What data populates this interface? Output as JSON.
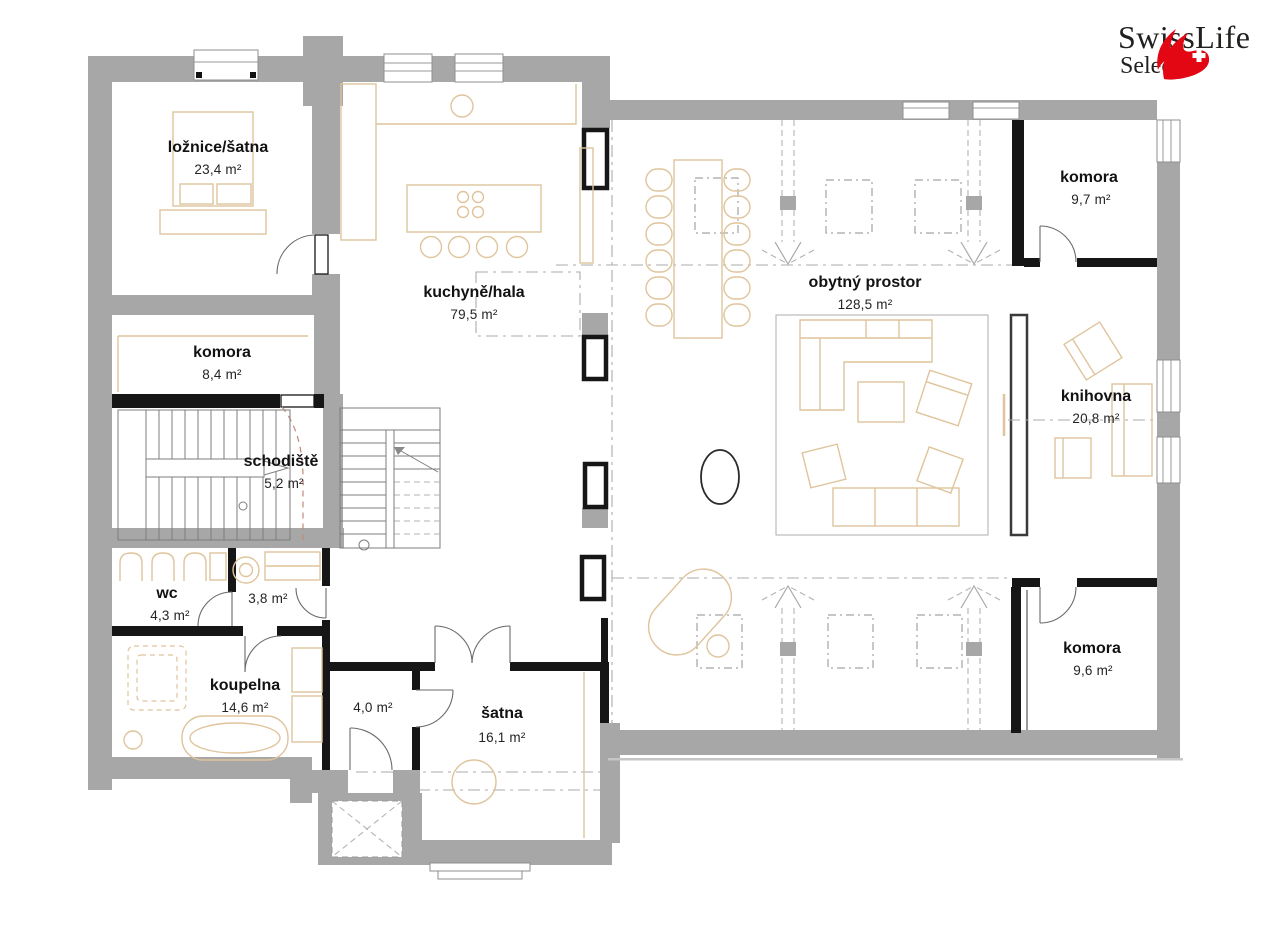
{
  "plan": {
    "rooms": [
      {
        "name": "ložnice/šatna",
        "area": "23,4 m²"
      },
      {
        "name": "kuchyně/hala",
        "area": "79,5 m²"
      },
      {
        "name": "komora",
        "area": "8,4 m²"
      },
      {
        "name": "schodiště",
        "area": "5,2 m²"
      },
      {
        "name": "wc",
        "area": "4,3 m²"
      },
      {
        "name": "",
        "area": "3,8 m²"
      },
      {
        "name": "koupelna",
        "area": "14,6 m²"
      },
      {
        "name": "",
        "area": "4,0 m²"
      },
      {
        "name": "šatna",
        "area": "16,1 m²"
      },
      {
        "name": "obytný prostor",
        "area": "128,5 m²"
      },
      {
        "name": "komora",
        "area": "9,7 m²"
      },
      {
        "name": "knihovna",
        "area": "20,8 m²"
      },
      {
        "name": "komora",
        "area": "9,6 m²"
      }
    ]
  },
  "logo": {
    "brand": "SwissLife",
    "subbrand": "Select"
  },
  "colors": {
    "exterior_wall": "#a7a7a7",
    "interior_wall": "#161616",
    "furniture": "#dfc49c",
    "logo_red": "#e30613"
  }
}
